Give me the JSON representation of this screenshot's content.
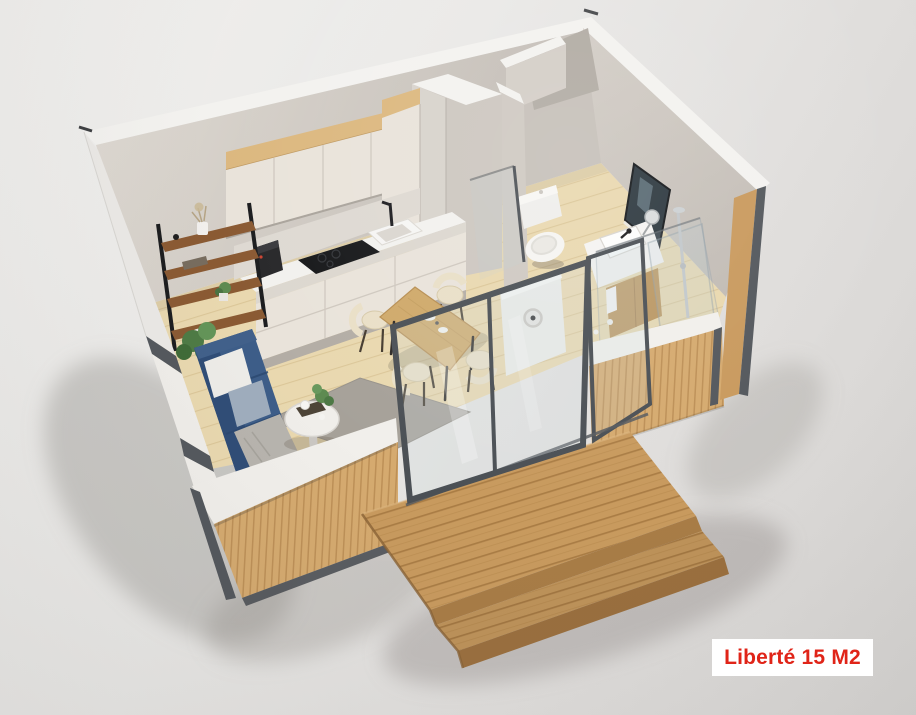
{
  "label": {
    "text": "Liberté 15 M2",
    "model_name": "Liberté",
    "area": "15 M2"
  },
  "palette": {
    "bg-top": "#f1f0ee",
    "bg-bottom": "#d5d3d1",
    "label-bg": "#ffffff",
    "label-red": "#e02418",
    "wall": "#d5cfc8",
    "wall-top": "#f3f2ef",
    "wood-slat": "#d5aa6f",
    "deck-wood": "#c89a5e",
    "floor-wood": "#e9d8af",
    "cabinet-cream": "#e9e3da",
    "oak-trim": "#dcb87f",
    "sofa-blue": "#3d5d88",
    "trim-dark": "#54585d",
    "rug-gray": "#a6a199",
    "table-oak": "#cfa96a",
    "chair-cream": "#e9dfc7",
    "fixture-white": "#f4f3f1"
  }
}
